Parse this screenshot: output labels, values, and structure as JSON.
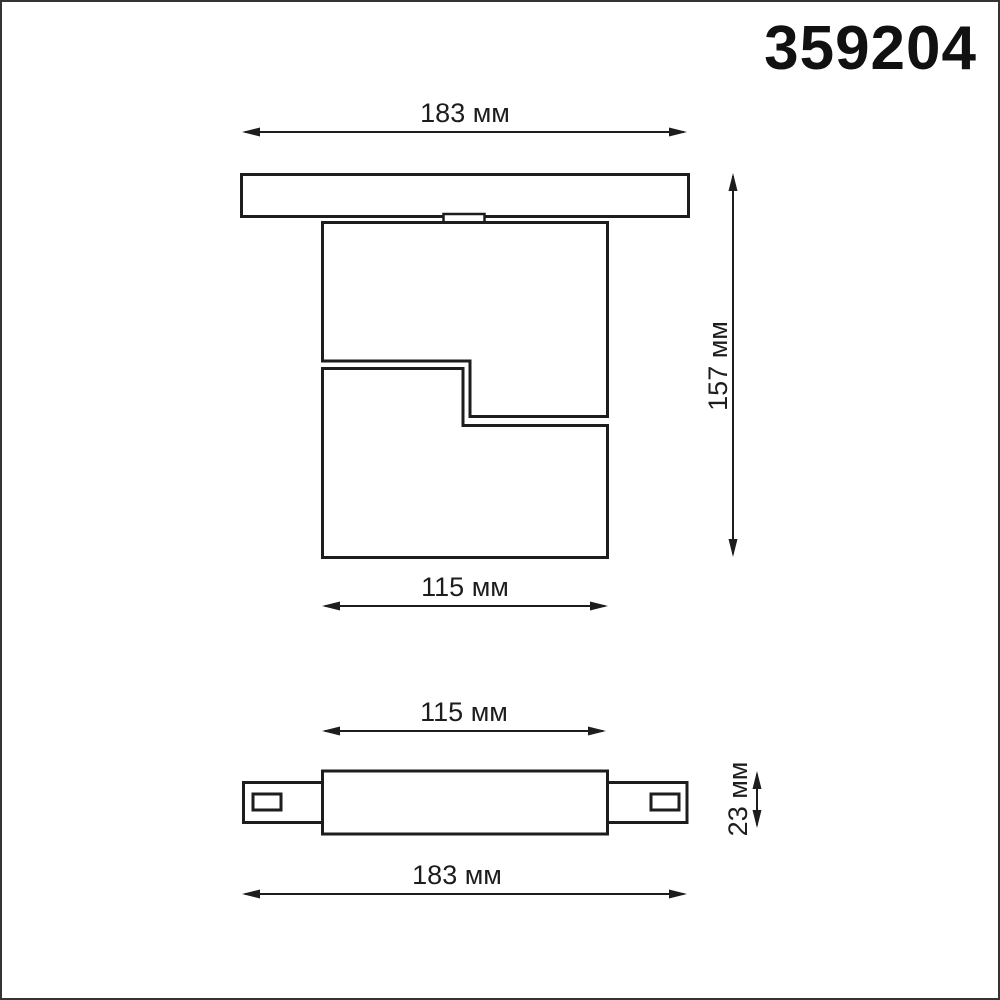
{
  "product_code": "359204",
  "unit": "мм",
  "colors": {
    "line": "#1d1d1b",
    "background": "#ffffff",
    "frame_border": "#343434"
  },
  "side_view": {
    "dim_track_length": "183 мм",
    "dim_height": "157 мм",
    "dim_body_width": "115 мм",
    "values_mm": {
      "track_length": 183,
      "height": 157,
      "body_width": 115
    }
  },
  "bottom_view": {
    "dim_body_width": "115 мм",
    "dim_depth": "23 мм",
    "dim_track_length": "183 мм",
    "values_mm": {
      "body_width": 115,
      "depth": 23,
      "track_length": 183
    }
  }
}
